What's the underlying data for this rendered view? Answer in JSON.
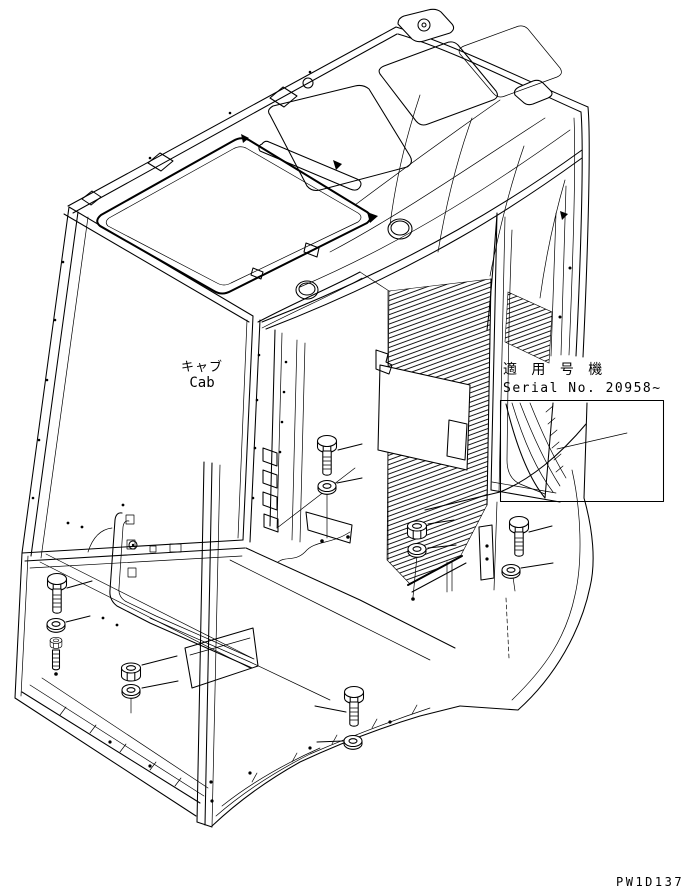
{
  "page": {
    "background": "#ffffff",
    "line_color": "#000000"
  },
  "labels": {
    "cab_ja": "キャブ",
    "cab_en": "Cab",
    "serial_applicability_ja": "適 用 号 機",
    "serial_number": "Serial No. 20958~",
    "drawing_code": "PW1D137"
  }
}
